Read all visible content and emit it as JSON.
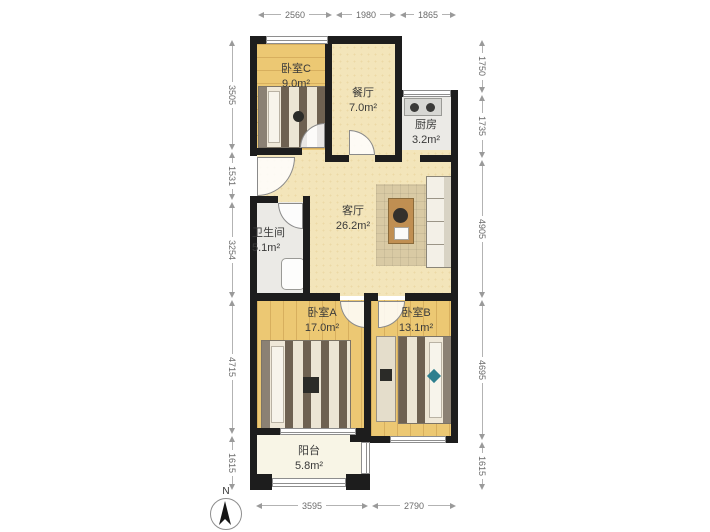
{
  "title": "apartment-floor-plan",
  "rooms": [
    {
      "name": "卧室C",
      "area": "9.0m²"
    },
    {
      "name": "餐厅",
      "area": "7.0m²"
    },
    {
      "name": "厨房",
      "area": "3.2m²"
    },
    {
      "name": "客厅",
      "area": "26.2m²"
    },
    {
      "name": "卫生间",
      "area": "5.1m²"
    },
    {
      "name": "卧室A",
      "area": "17.0m²"
    },
    {
      "name": "卧室B",
      "area": "13.1m²"
    },
    {
      "name": "阳台",
      "area": "5.8m²"
    }
  ],
  "dimensions": {
    "top": [
      "2560",
      "1980",
      "1865"
    ],
    "bottom": [
      "3595",
      "2790"
    ],
    "left": [
      "3505",
      "1531",
      "3254",
      "4715",
      "1615"
    ],
    "right": [
      "1750",
      "1735",
      "4905",
      "4695",
      "1615"
    ]
  },
  "compass": {
    "label": "N"
  },
  "colors": {
    "wall": "#1d1d1d",
    "wood_floor": "#ecc873",
    "living_floor": "#f3e5ba",
    "kitchen_floor": "#ebeae6",
    "balcony_floor": "#f8f5e6",
    "dimension_line": "#b3b3b3",
    "dimension_text": "#6b6b6b",
    "label_text": "#3a3a3a"
  }
}
